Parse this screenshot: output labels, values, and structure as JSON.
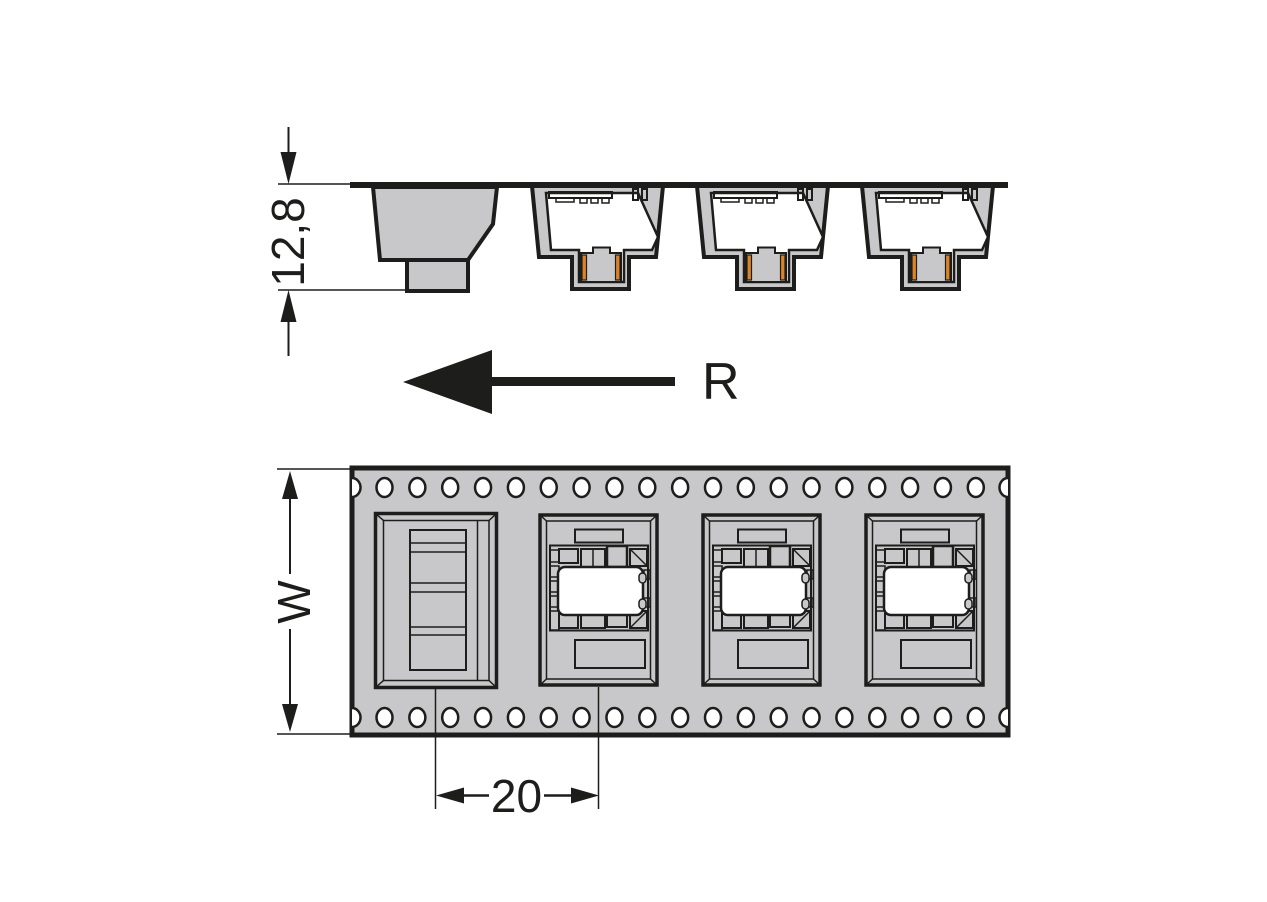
{
  "labels": {
    "reel_direction": "R"
  },
  "dimensions": {
    "height": "12,8",
    "tape_width": "W",
    "pocket_pitch": "20"
  },
  "tape": {
    "sprocket_holes_per_row": 19,
    "sprocket_hole_rows": 2,
    "side_view_pockets": 4,
    "top_view_pockets": 4,
    "pockets_with_component": 3,
    "empty_pockets": 1
  },
  "colors": {
    "outline_ink": "#1d1d1b",
    "tape_gray": "#c8c8ca",
    "contact_orange": "#dd8227",
    "background": "#ffffff"
  }
}
